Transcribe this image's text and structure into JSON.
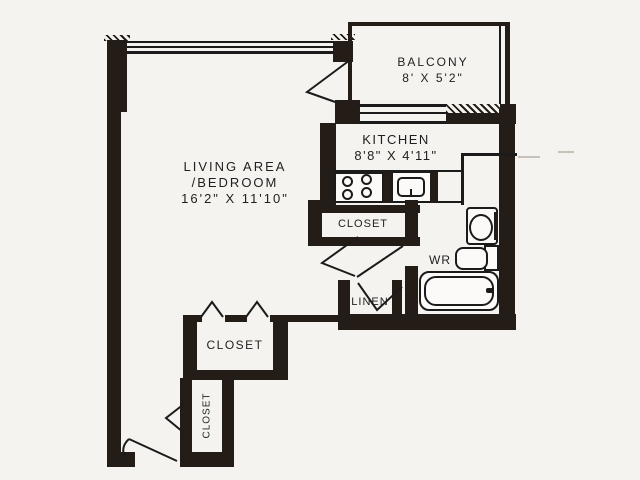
{
  "document": {
    "type": "apartment-floor-plan"
  },
  "palette": {
    "wall": "#241d17",
    "line": "#1b1b1b",
    "paper": "#f5f3ef",
    "text": "#1f1f1f"
  },
  "rooms": {
    "living": {
      "label": "LIVING AREA",
      "label2": "/BEDROOM",
      "dimensions": "16'2\" X 11'10\""
    },
    "balcony": {
      "label": "BALCONY",
      "dimensions": "8' X 5'2\""
    },
    "kitchen": {
      "label": "KITCHEN",
      "dimensions": "8'8\" X 4'11\""
    },
    "kitchen_closet": {
      "label": "CLOSET"
    },
    "linen_closet": {
      "label": "LINEN"
    },
    "washroom": {
      "label": "WR"
    },
    "bedroom_closet": {
      "label": "CLOSET"
    },
    "entry_closet": {
      "label": "CLOSET"
    }
  },
  "fixtures": {
    "stove": "stove-icon",
    "kitchen_sink": "kitchen-sink-icon",
    "toilet": "toilet-icon",
    "washbasin": "washbasin-icon",
    "bathtub": "bathtub-icon"
  }
}
